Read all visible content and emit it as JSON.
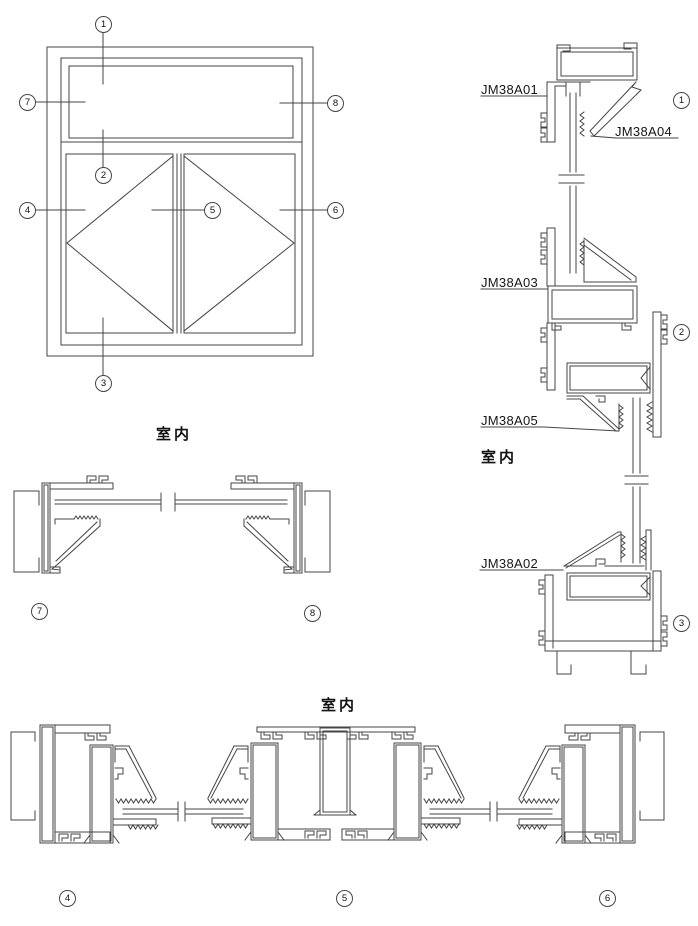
{
  "page": {
    "background": "#ffffff",
    "line_color": "#454545",
    "text_color": "#111111"
  },
  "drawing": {
    "captions": {
      "room_elevation": "室内",
      "room_right": "室内",
      "room_bottom": "室内"
    },
    "labels": {
      "a01": "JM38A01",
      "a04": "JM38A04",
      "a03": "JM38A03",
      "a05": "JM38A05",
      "a02": "JM38A02"
    },
    "callouts": {
      "e1": "1",
      "e2": "2",
      "e3": "3",
      "e4": "4",
      "e5": "5",
      "e6": "6",
      "e7": "7",
      "e8": "8",
      "s1": "1",
      "s2": "2",
      "s3": "3",
      "s7": "7",
      "s8": "8",
      "s4": "4",
      "s5": "5",
      "s6": "6"
    }
  }
}
